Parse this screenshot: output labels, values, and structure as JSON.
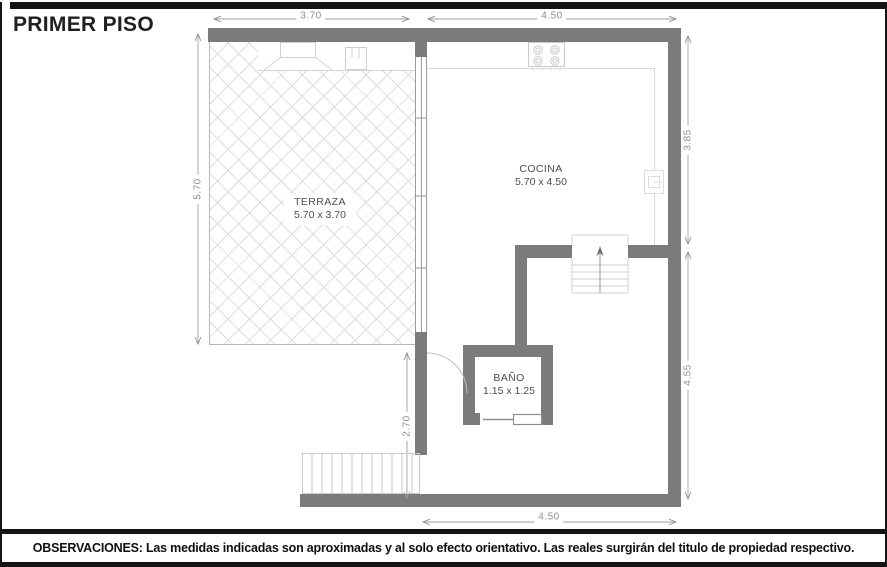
{
  "title": "PRIMER PISO",
  "plan": {
    "rooms": {
      "terraza": {
        "name": "TERRAZA",
        "size": "5.70 x 3.70"
      },
      "cocina": {
        "name": "COCINA",
        "size": "5.70 x 4.50"
      },
      "bano": {
        "name": "BAÑO",
        "size": "1.15 x 1.25"
      }
    },
    "dimensions": {
      "top_terraza": "3.70",
      "top_cocina": "4.50",
      "left_terraza": "5.70",
      "right_upper": "3.85",
      "right_lower": "4.55",
      "inner_passage": "2.70",
      "bottom_cocina": "4.50"
    }
  },
  "footer": {
    "observations": "OBSERVACIONES: Las medidas indicadas son aproximadas y al solo efecto orientativo. Las reales surgirán del titulo de propiedad respectivo."
  },
  "colors": {
    "wall": "#7b7b7b",
    "dimension": "#8f8f8f",
    "hatch": "#dddddd",
    "frame": "#141414"
  }
}
